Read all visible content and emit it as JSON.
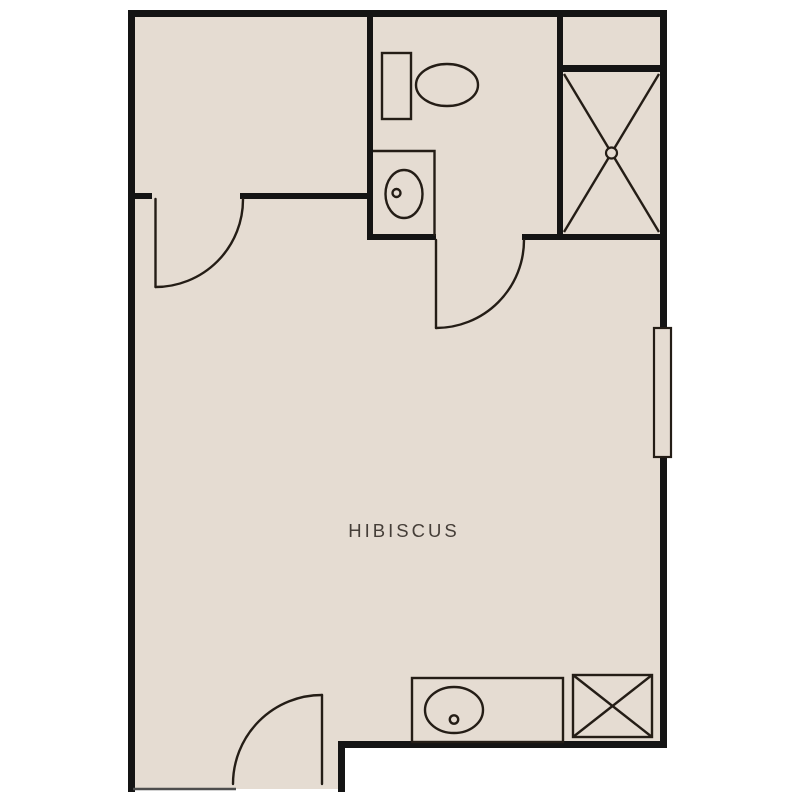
{
  "room": {
    "label": "HIBISCUS"
  },
  "colors": {
    "background": "#ffffff",
    "floor": "#e5dcd2",
    "wall": "#141414",
    "fixture": "#241d16",
    "threshold": "#4d4d4d",
    "label": "#453e38"
  },
  "symbols": [
    "toilet",
    "sink",
    "shower-with-drain",
    "vanity-sink",
    "crossed-box",
    "window",
    "door-swing",
    "door-swing",
    "door-swing"
  ]
}
